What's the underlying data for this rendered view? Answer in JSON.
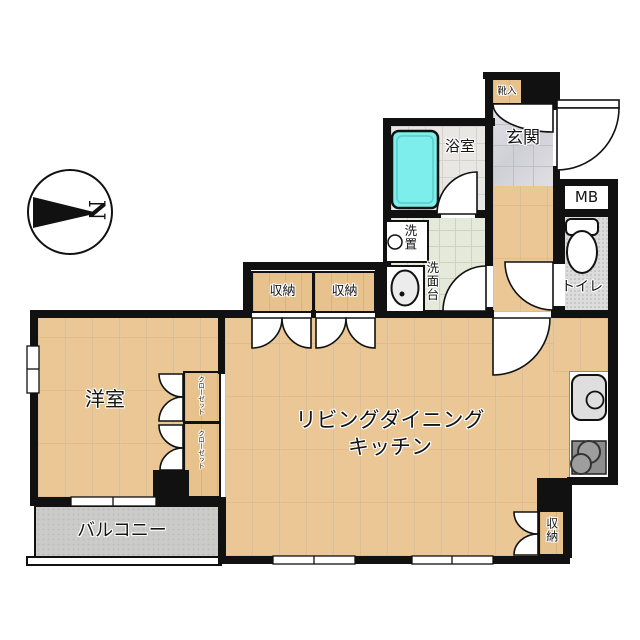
{
  "plan": {
    "compass_label": "N",
    "shoe_cabinet": "靴入",
    "entrance": "玄関",
    "bathroom": "浴室",
    "meter_box": "MB",
    "toilet": "トイレ",
    "laundry": "洗置",
    "washstand": "洗面台",
    "hall_storage_left": "収納",
    "hall_storage_right": "収納",
    "western_room": "洋室",
    "closet_upper": "クローゼット",
    "closet_lower": "クローゼット",
    "ldk_line1": "リビングダイニング",
    "ldk_line2": "キッチン",
    "ldk_storage": "収納",
    "balcony": "バルコニー"
  },
  "colors": {
    "wall": "#111111",
    "wood_floor": "#eac795",
    "storage_tan": "#e7c28c",
    "bathtub": "#7deeeb",
    "balcony_gray": "#cbcbc9",
    "toilet_floor": "#dcdcdc",
    "washroom_floor": "#e4e9da"
  }
}
